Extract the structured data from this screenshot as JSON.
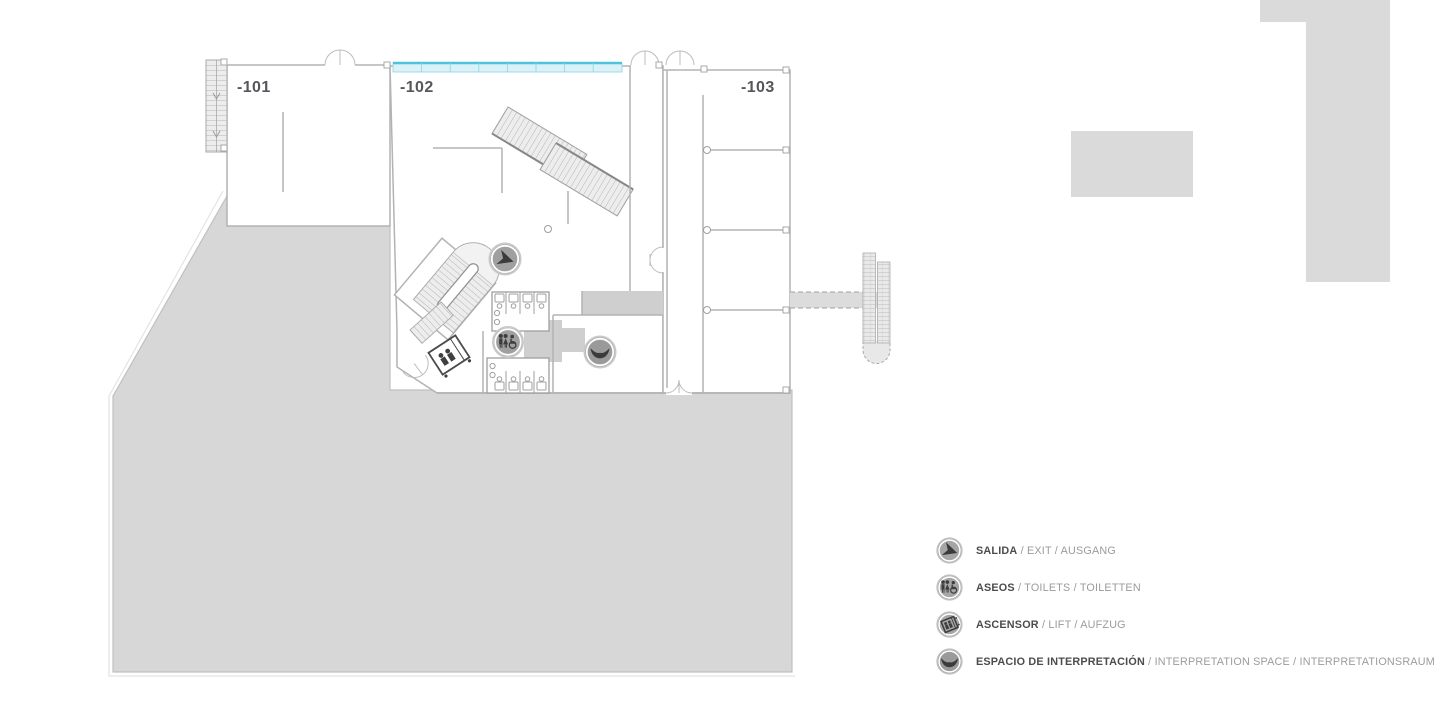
{
  "page": {
    "title": "Floor plan level -1",
    "background": "#ffffff"
  },
  "level_indicator": {
    "label": "-1",
    "color": "#dadada"
  },
  "plan": {
    "room_labels": [
      {
        "id": "room-101",
        "label": "-101"
      },
      {
        "id": "room-102",
        "label": "-102"
      },
      {
        "id": "room-103",
        "label": "-103"
      }
    ],
    "icons_on_plan": [
      "salida-exit",
      "aseos-toilets",
      "ascensor-lift",
      "espacio-de-interpretacion"
    ],
    "colors": {
      "terrace_fill": "#d7d7d7",
      "wall_stroke": "#b3b3b3",
      "skylight_fill": "#d9f1f7",
      "skylight_border": "#4fc2dc",
      "corridor_fill": "#cfcfcf",
      "icon_disc": "#a0a0a0",
      "icon_glyph": "#3d3d3d",
      "label_text": "#56575a"
    }
  },
  "legend": {
    "items": [
      {
        "id": "salida",
        "primary": "SALIDA",
        "secondary": " / EXIT / AUSGANG"
      },
      {
        "id": "aseos",
        "primary": "ASEOS",
        "secondary": " / TOILETS / TOILETTEN"
      },
      {
        "id": "ascensor",
        "primary": "ASCENSOR",
        "secondary": " / LIFT / AUFZUG"
      },
      {
        "id": "espacio",
        "primary": "ESPACIO DE INTERPRETACIÓN",
        "secondary": " / INTERPRETATION SPACE / INTERPRETATIONSRAUM"
      }
    ]
  }
}
